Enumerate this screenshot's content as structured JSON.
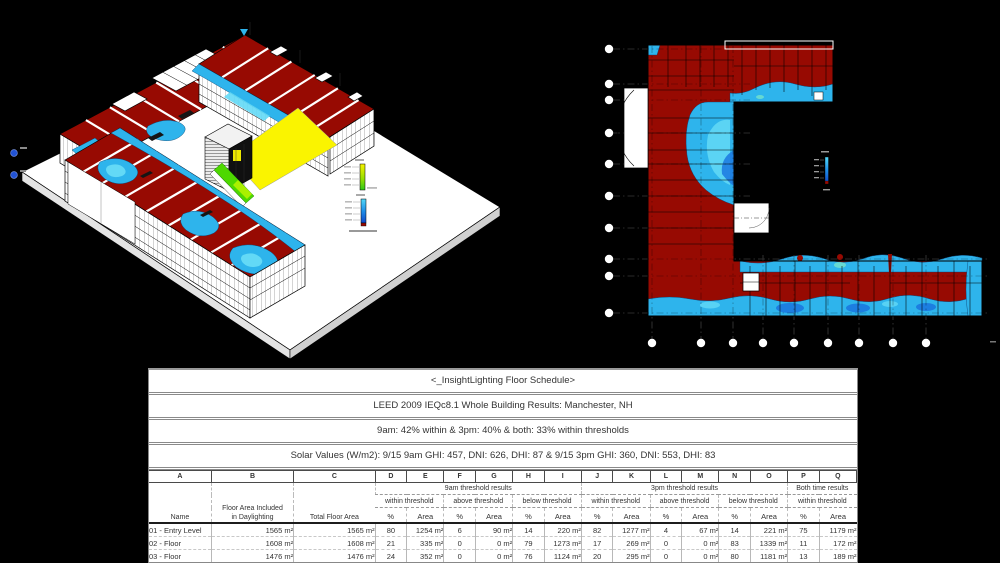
{
  "palette": {
    "bg": "#000000",
    "above": "#970a02",
    "below": "#2eb4ec",
    "below-deep": "#1b78e0",
    "below-light": "#63d9f6",
    "within-yellow": "#faf400",
    "within-green": "#4ed800",
    "slab": "#ffffff",
    "axis-blue": "#2253d4"
  },
  "legend_colors": {
    "upper_bar": [
      "#f6f200",
      "#9ae000",
      "#2ec818"
    ],
    "lower_bar": [
      "#52d8f8",
      "#1f8fe8",
      "#0f46c8",
      "#970a02"
    ]
  },
  "table": {
    "title": "<_InsightLighting Floor Schedule>",
    "location_line": "LEED 2009 IEQc8.1 Whole Building Results: Manchester, NH",
    "summary_line": "9am: 42% within & 3pm: 40% & both: 33% within thresholds",
    "solar_line": "Solar Values (W/m2): 9/15 9am GHI: 457, DNI: 626, DHI: 87 & 9/15 3pm GHI: 360, DNI: 553, DHI: 83",
    "column_letters": [
      "A",
      "B",
      "C",
      "D",
      "E",
      "F",
      "G",
      "H",
      "I",
      "J",
      "K",
      "L",
      "M",
      "N",
      "O",
      "P",
      "Q"
    ],
    "groups": {
      "g9am": "9am threshold results",
      "g3pm": "3pm threshold results",
      "gboth": "Both time results"
    },
    "subs": {
      "within": "within threshold",
      "above": "above threshold",
      "below": "below threshold"
    },
    "headers": {
      "name": "Name",
      "fai1": "Floor Area Included",
      "fai2": "in Daylighting",
      "total": "Total Floor Area",
      "pct": "%",
      "area": "Area"
    },
    "rows": [
      {
        "name": "01 - Entry Level",
        "b": "1565 m²",
        "c": "1565 m²",
        "d": "80",
        "e": "1254 m²",
        "f": "6",
        "g": "90 m²",
        "h": "14",
        "i": "220 m²",
        "j": "82",
        "k": "1277 m²",
        "l": "4",
        "m": "67 m²",
        "n": "14",
        "o": "221 m²",
        "p": "75",
        "q": "1179 m²"
      },
      {
        "name": "02 - Floor",
        "b": "1608 m²",
        "c": "1608 m²",
        "d": "21",
        "e": "335 m²",
        "f": "0",
        "g": "0 m²",
        "h": "79",
        "i": "1273 m²",
        "j": "17",
        "k": "269 m²",
        "l": "0",
        "m": "0 m²",
        "n": "83",
        "o": "1339 m²",
        "p": "11",
        "q": "172 m²"
      },
      {
        "name": "03 - Floor",
        "b": "1476 m²",
        "c": "1476 m²",
        "d": "24",
        "e": "352 m²",
        "f": "0",
        "g": "0 m²",
        "h": "76",
        "i": "1124 m²",
        "j": "20",
        "k": "295 m²",
        "l": "0",
        "m": "0 m²",
        "n": "80",
        "o": "1181 m²",
        "p": "13",
        "q": "189 m²"
      }
    ]
  }
}
